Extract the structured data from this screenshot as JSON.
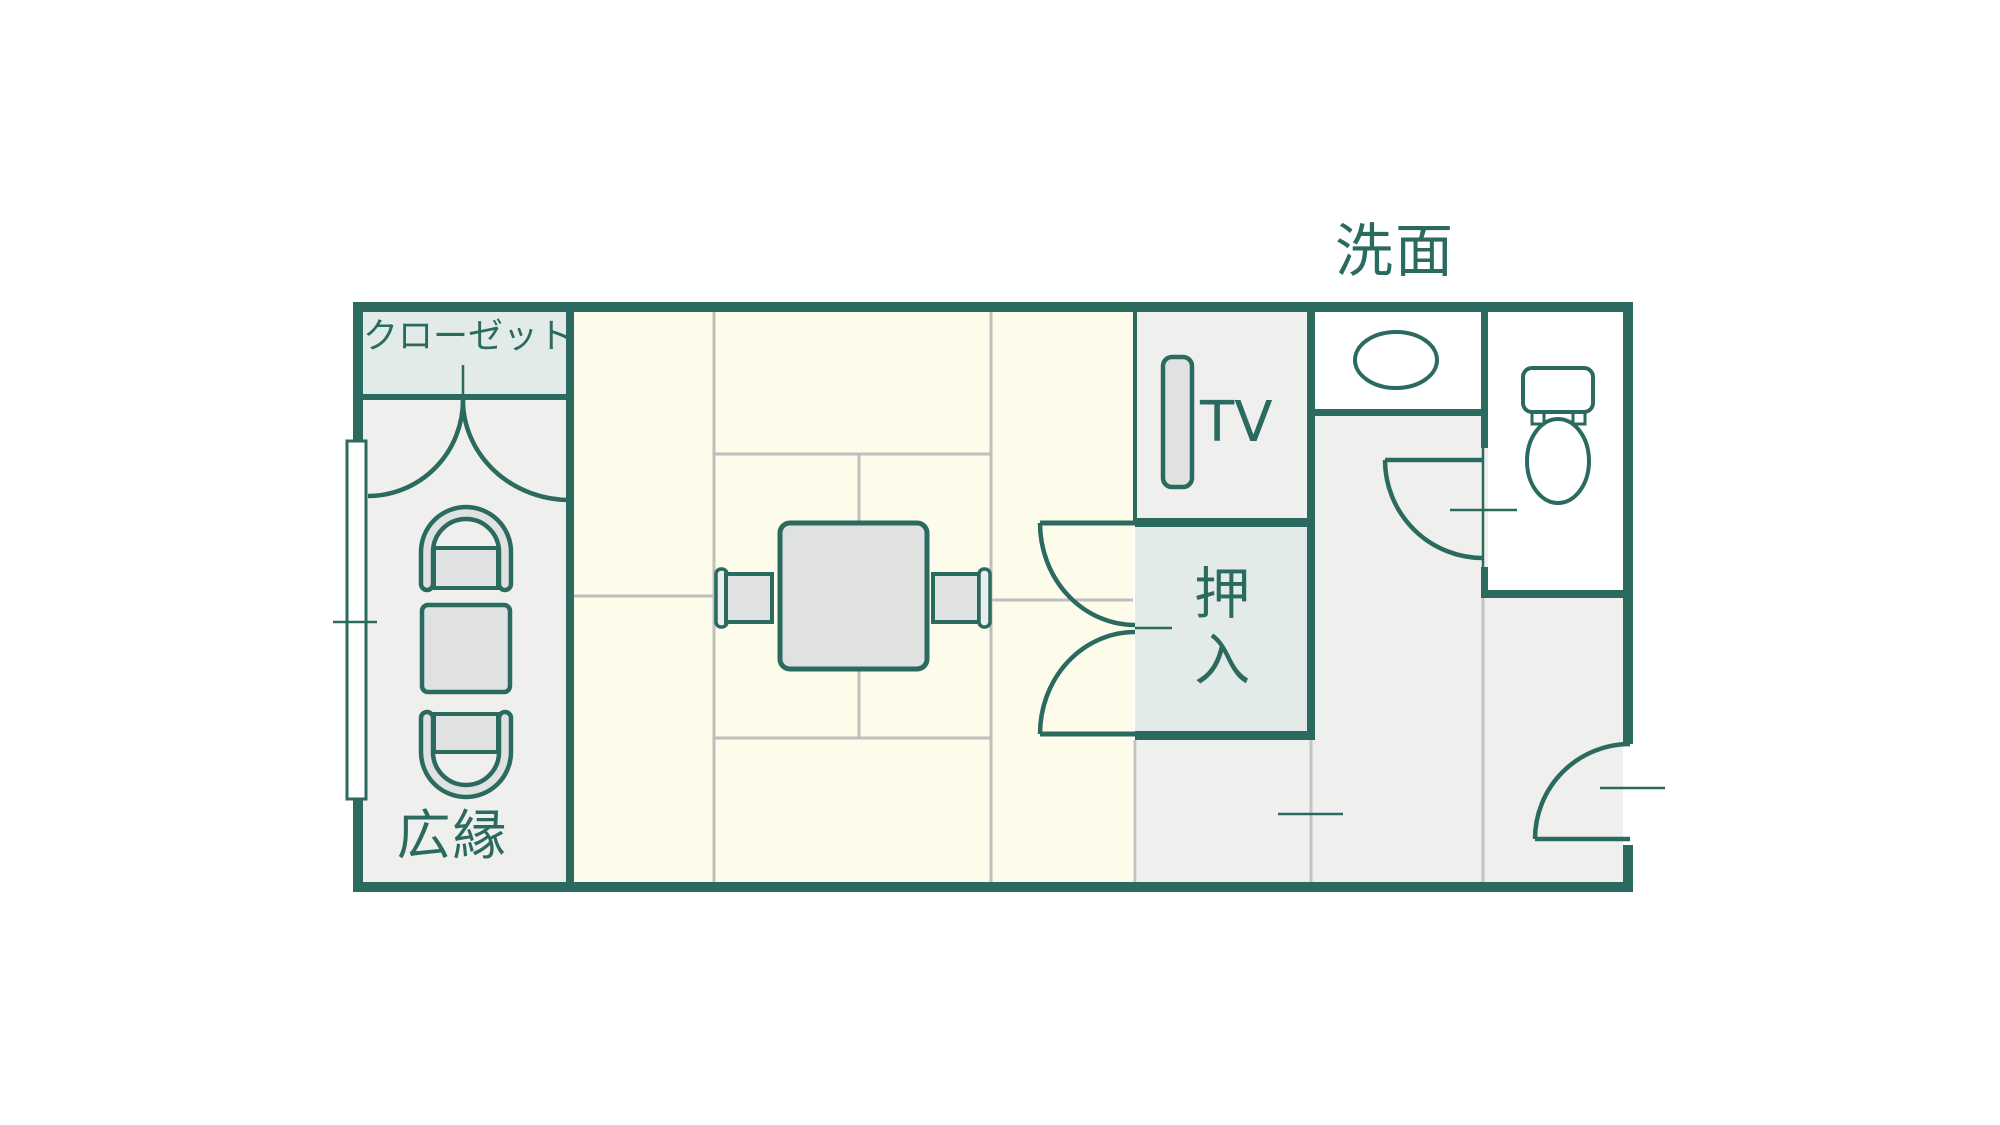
{
  "plan": {
    "type": "japanese-guest-room-floor-plan",
    "labels": {
      "closet": "クローゼット",
      "hiroen": "広縁",
      "washbasin": "洗面",
      "tv": "TV",
      "oshiire": "押入"
    },
    "rooms": [
      {
        "name": "closet",
        "label": "クローゼット"
      },
      {
        "name": "hiroen-veranda",
        "label": "広縁"
      },
      {
        "name": "tatami-room",
        "label": ""
      },
      {
        "name": "tv-nook",
        "label": "TV"
      },
      {
        "name": "oshiire-futon-closet",
        "label": "押入"
      },
      {
        "name": "washbasin-area",
        "label": "洗面"
      },
      {
        "name": "toilet-room",
        "label": ""
      }
    ],
    "colors": {
      "wall": "#2B6A5F",
      "tatami_floor": "#FDFCEA",
      "wood_floor": "#EFF0EE",
      "storage_fill": "#E2EBE8",
      "furniture_fill": "#DFE2E0",
      "mat_line": "#BDBFBC",
      "divider_line": "#C2C4C2",
      "background": "#FFFFFF"
    }
  }
}
